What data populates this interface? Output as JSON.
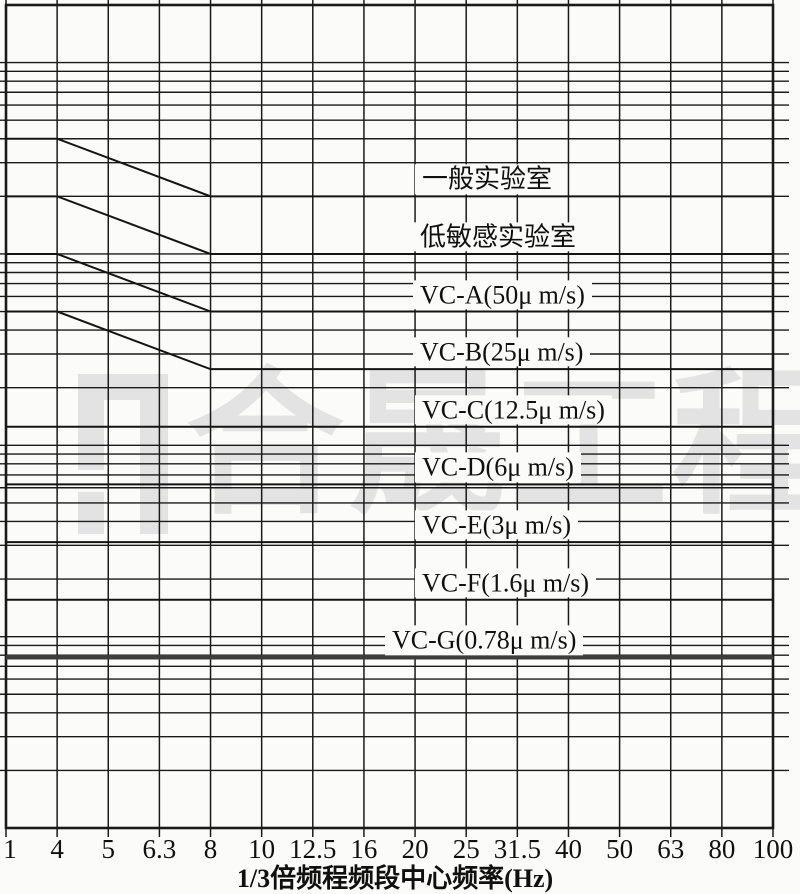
{
  "figure": {
    "background_color": "#fbfbf9",
    "line_color": "#1a1a1a",
    "watermark": {
      "text": "合晟工程",
      "color": "#e3e3e3"
    }
  },
  "axis": {
    "title": "1/3倍频程频段中心频率(Hz)",
    "tick_labels": [
      "1",
      "4",
      "5",
      "6.3",
      "8",
      "10",
      "12.5",
      "16",
      "20",
      "25",
      "31.5",
      "40",
      "50",
      "63",
      "80",
      "100"
    ]
  },
  "chart_data": {
    "type": "line",
    "title": "",
    "xlabel": "1/3倍频程频段中心频率(Hz)",
    "ylabel": "",
    "x_mode": "1/3-octave bands, equally spaced on axis",
    "x_bands": [
      1,
      4,
      5,
      6.3,
      8,
      10,
      12.5,
      16,
      20,
      25,
      31.5,
      40,
      50,
      63,
      80,
      100
    ],
    "y_axis": {
      "scale": "log",
      "unit": "μm/s",
      "min": 0.1,
      "max": 2000,
      "gridline_values": [
        1000,
        900,
        800,
        700,
        600,
        500,
        400,
        300,
        200,
        100,
        90,
        80,
        70,
        60,
        50,
        40,
        30,
        20,
        10,
        9,
        8,
        7,
        6,
        5,
        4,
        3,
        2,
        1,
        0.9,
        0.8,
        0.7,
        0.6,
        0.5,
        0.4,
        0.3,
        0.2
      ]
    },
    "grid": true,
    "legend_position": "labels on curves",
    "series": [
      {
        "name": "general-laboratory",
        "label": "一般实验室",
        "label_x": 415,
        "points": [
          [
            1,
            400
          ],
          [
            4,
            400
          ],
          [
            8,
            200
          ],
          [
            100,
            200
          ]
        ],
        "thick": false
      },
      {
        "name": "low-sensitivity-laboratory",
        "label": "低敏感实验室",
        "label_x": 413,
        "points": [
          [
            1,
            200
          ],
          [
            4,
            200
          ],
          [
            8,
            100
          ],
          [
            100,
            100
          ]
        ],
        "thick": false
      },
      {
        "name": "vc-a",
        "label": "VC-A(50μ m/s)",
        "label_x": 413,
        "points": [
          [
            1,
            100
          ],
          [
            4,
            100
          ],
          [
            8,
            50
          ],
          [
            100,
            50
          ]
        ],
        "thick": false
      },
      {
        "name": "vc-b",
        "label": "VC-B(25μ m/s)",
        "label_x": 413,
        "points": [
          [
            1,
            50
          ],
          [
            4,
            50
          ],
          [
            8,
            25
          ],
          [
            100,
            25
          ]
        ],
        "thick": false
      },
      {
        "name": "vc-c",
        "label": "VC-C(12.5μ m/s)",
        "label_x": 415,
        "points": [
          [
            1,
            12.5
          ],
          [
            100,
            12.5
          ]
        ],
        "thick": false
      },
      {
        "name": "vc-d",
        "label": "VC-D(6μ m/s)",
        "label_x": 415,
        "points": [
          [
            1,
            6.25
          ],
          [
            100,
            6.25
          ]
        ],
        "thick": false
      },
      {
        "name": "vc-e",
        "label": "VC-E(3μ m/s)",
        "label_x": 415,
        "points": [
          [
            1,
            3.12
          ],
          [
            100,
            3.12
          ]
        ],
        "thick": false
      },
      {
        "name": "vc-f",
        "label": "VC-F(1.6μ m/s)",
        "label_x": 415,
        "points": [
          [
            1,
            1.56
          ],
          [
            100,
            1.56
          ]
        ],
        "thick": false
      },
      {
        "name": "vc-g",
        "label": "VC-G(0.78μ m/s)",
        "label_x": 385,
        "points": [
          [
            1,
            0.78
          ],
          [
            100,
            0.78
          ]
        ],
        "thick": true
      }
    ]
  }
}
